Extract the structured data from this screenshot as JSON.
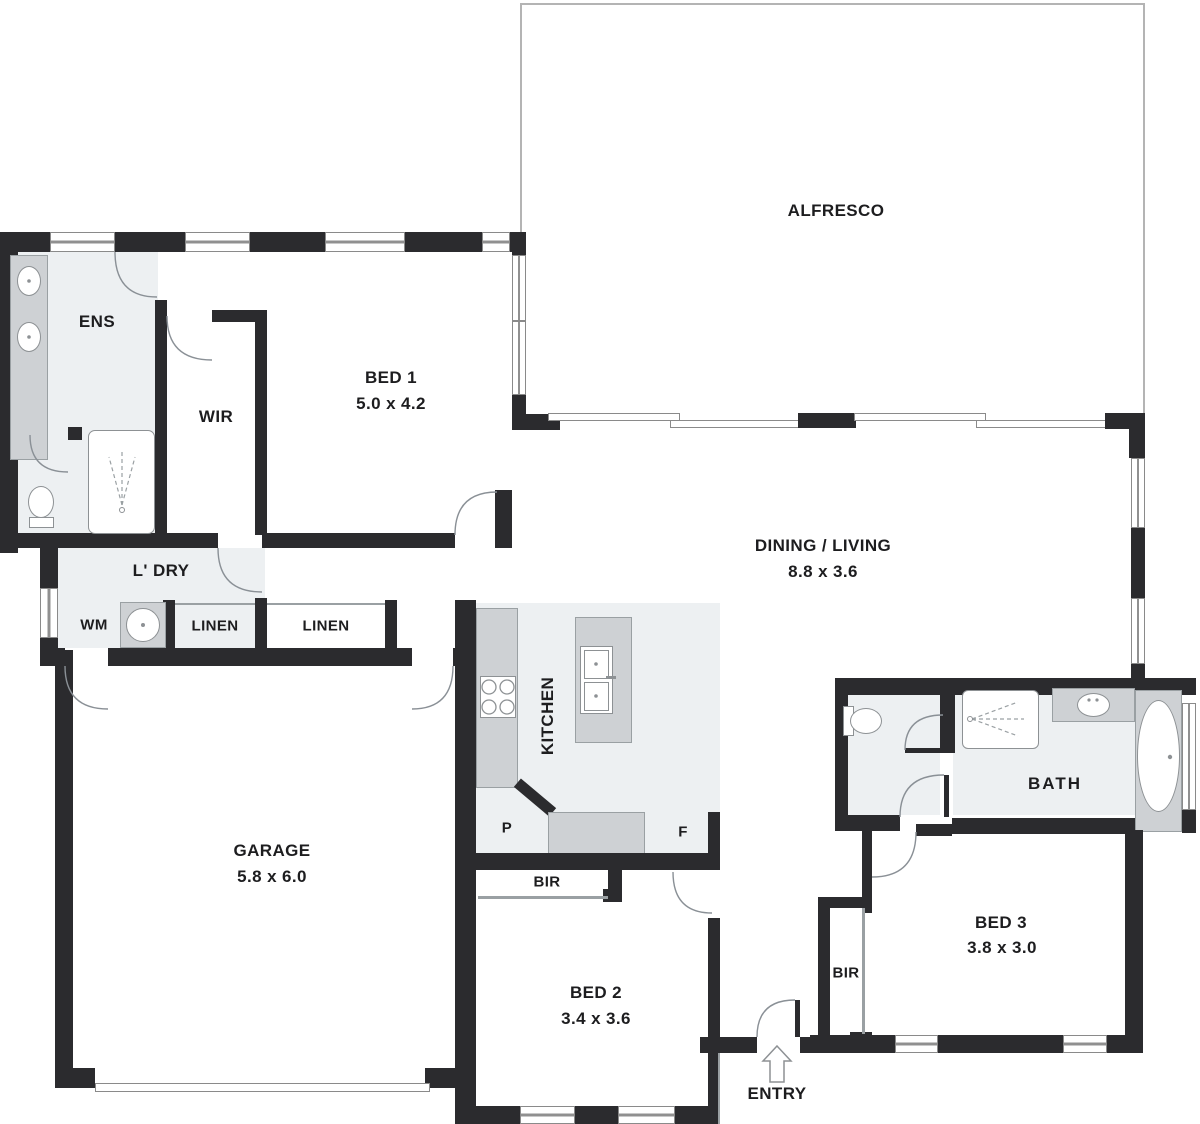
{
  "palette": {
    "wall": "#2b2b2e",
    "room_light_fill": "#edf0f2",
    "fixture_gray": "#ced1d4",
    "line_gray": "#9aa0a3",
    "text": "#1d1d1f",
    "background": "#ffffff"
  },
  "rooms": {
    "alfresco": {
      "name": "ALFRESCO"
    },
    "bed1": {
      "name": "BED 1",
      "dims": "5.0 x 4.2"
    },
    "ens": {
      "name": "ENS"
    },
    "wir": {
      "name": "WIR"
    },
    "dining_living": {
      "name": "DINING / LIVING",
      "dims": "8.8 x 3.6"
    },
    "laundry": {
      "name": "L' DRY"
    },
    "wm": {
      "name": "WM"
    },
    "linen1": {
      "name": "LINEN"
    },
    "linen2": {
      "name": "LINEN"
    },
    "kitchen": {
      "name": "KITCHEN"
    },
    "pantry": {
      "name": "P"
    },
    "fridge": {
      "name": "F"
    },
    "garage": {
      "name": "GARAGE",
      "dims": "5.8 x 6.0"
    },
    "bir_bed2": {
      "name": "BIR"
    },
    "bed2": {
      "name": "BED 2",
      "dims": "3.4 x 3.6"
    },
    "bath": {
      "name": "BATH"
    },
    "bir_bed3": {
      "name": "BIR"
    },
    "bed3": {
      "name": "BED 3",
      "dims": "3.8 x 3.0"
    },
    "entry": {
      "name": "ENTRY"
    }
  }
}
